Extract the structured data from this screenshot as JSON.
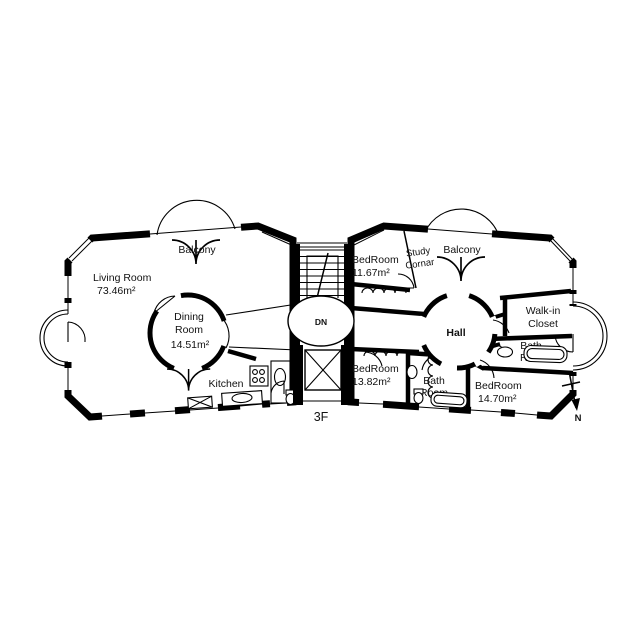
{
  "floor_plan": {
    "floor_label": "3F",
    "compass_label": "N",
    "stairs_label": "DN",
    "colors": {
      "ink": "#000000",
      "paper": "#ffffff"
    },
    "left_wing": {
      "balcony": "Balcony",
      "living_room_name": "Living Room",
      "living_room_area": "73.46m²",
      "dining_room_line1": "Dining",
      "dining_room_line2": "Room",
      "dining_room_area": "14.51m²",
      "kitchen": "Kitchen"
    },
    "right_wing": {
      "bedroom_top_name": "BedRoom",
      "bedroom_top_area": "11.67m²",
      "study_line1": "Study",
      "study_line2": "Cornar",
      "balcony": "Balcony",
      "hall": "Hall",
      "walk_in_line1": "Walk-in",
      "walk_in_line2": "Closet",
      "bath_right_line1": "Bath",
      "bath_right_line2": "Room",
      "bedroom_left_name": "BedRoom",
      "bedroom_left_area": "13.82m²",
      "bath_bottom_line1": "Bath",
      "bath_bottom_line2": "Room",
      "bedroom_right_name": "BedRoom",
      "bedroom_right_area": "14.70m²"
    }
  }
}
